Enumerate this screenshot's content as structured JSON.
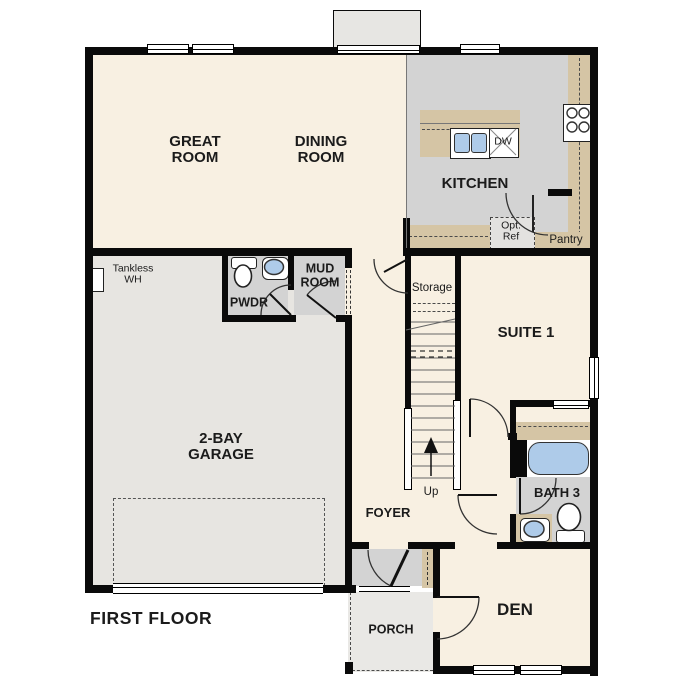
{
  "title": {
    "floor_label": "FIRST FLOOR"
  },
  "rooms": {
    "great_room": "GREAT ROOM",
    "dining_room": "DINING ROOM",
    "kitchen": "KITCHEN",
    "garage": "2-BAY GARAGE",
    "powder": "PWDR",
    "mud_room": "MUD ROOM",
    "suite_1": "SUITE 1",
    "bath_3": "BATH 3",
    "den": "DEN",
    "foyer": "FOYER",
    "porch": "PORCH",
    "pantry": "Pantry",
    "storage": "Storage"
  },
  "annotations": {
    "stairs_direction": "Up",
    "dishwasher": "DW",
    "optional_refrigerator": "Opt. Ref",
    "tankless_water_heater": "Tankless WH"
  },
  "colors": {
    "wall": "#0a0a0a",
    "cream": "#f8f0e2",
    "room_gray": "#d3d3d3",
    "garage_gray": "#e7e5e1",
    "porch_gray": "#e9e8e5",
    "tan": "#d5c5a5",
    "fixture_blue": "#aecbe9",
    "bumpout": "#e7e6e3"
  }
}
